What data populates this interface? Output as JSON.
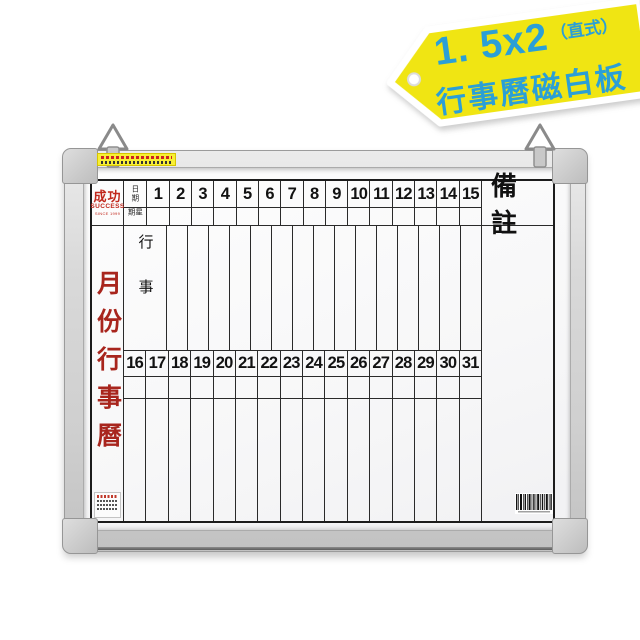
{
  "badge": {
    "size_label": "1. 5x2",
    "orientation_label": "（直式）",
    "product_label": "行事曆磁白板",
    "bg_color": "#f0e513",
    "text_color": "#2b9fd6"
  },
  "board": {
    "brand": {
      "logo_cn": "成功",
      "logo_en": "SUCCESS",
      "since": "SINCE 1999"
    },
    "title": "月份行事曆",
    "calendar": {
      "date_label": "日期",
      "week_label": "星期",
      "events_label": "行事",
      "notes_label": "備註",
      "days_first_half": [
        1,
        2,
        3,
        4,
        5,
        6,
        7,
        8,
        9,
        10,
        11,
        12,
        13,
        14,
        15
      ],
      "days_second_half": [
        16,
        17,
        18,
        19,
        20,
        21,
        22,
        23,
        24,
        25,
        26,
        27,
        28,
        29,
        30,
        31
      ]
    },
    "colors": {
      "title_red": "#a8251d",
      "grid_line": "#2a2a2a",
      "frame_gray": "#d6d6d6"
    }
  }
}
